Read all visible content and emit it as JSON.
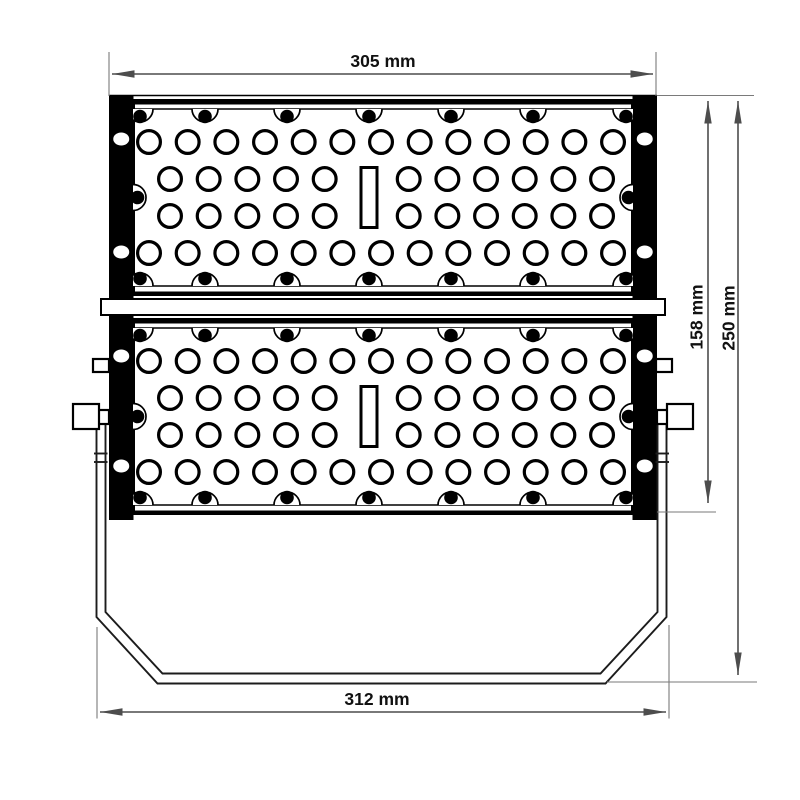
{
  "drawing": {
    "title": "Floodlight front view dimensional drawing",
    "labels": {
      "top_width": "305 mm",
      "module_height": "158 mm",
      "overall_height": "250 mm",
      "bottom_width": "312 mm"
    },
    "colors": {
      "linework": "#000000",
      "bracket": "#1c1c1c",
      "dimension_line": "#4d4d4d",
      "extension_line": "#7a7a7a",
      "label_text": "#111111",
      "background": "#ffffff"
    },
    "fixture": {
      "module_count": 2,
      "led_hole_rows_per_module": 4,
      "full_row_hole_count": 13,
      "split_row_hole_counts": [
        5,
        6
      ],
      "screw_dots_per_edge": 5,
      "rail_holes_per_side": 4,
      "slots_per_module": 1
    }
  }
}
